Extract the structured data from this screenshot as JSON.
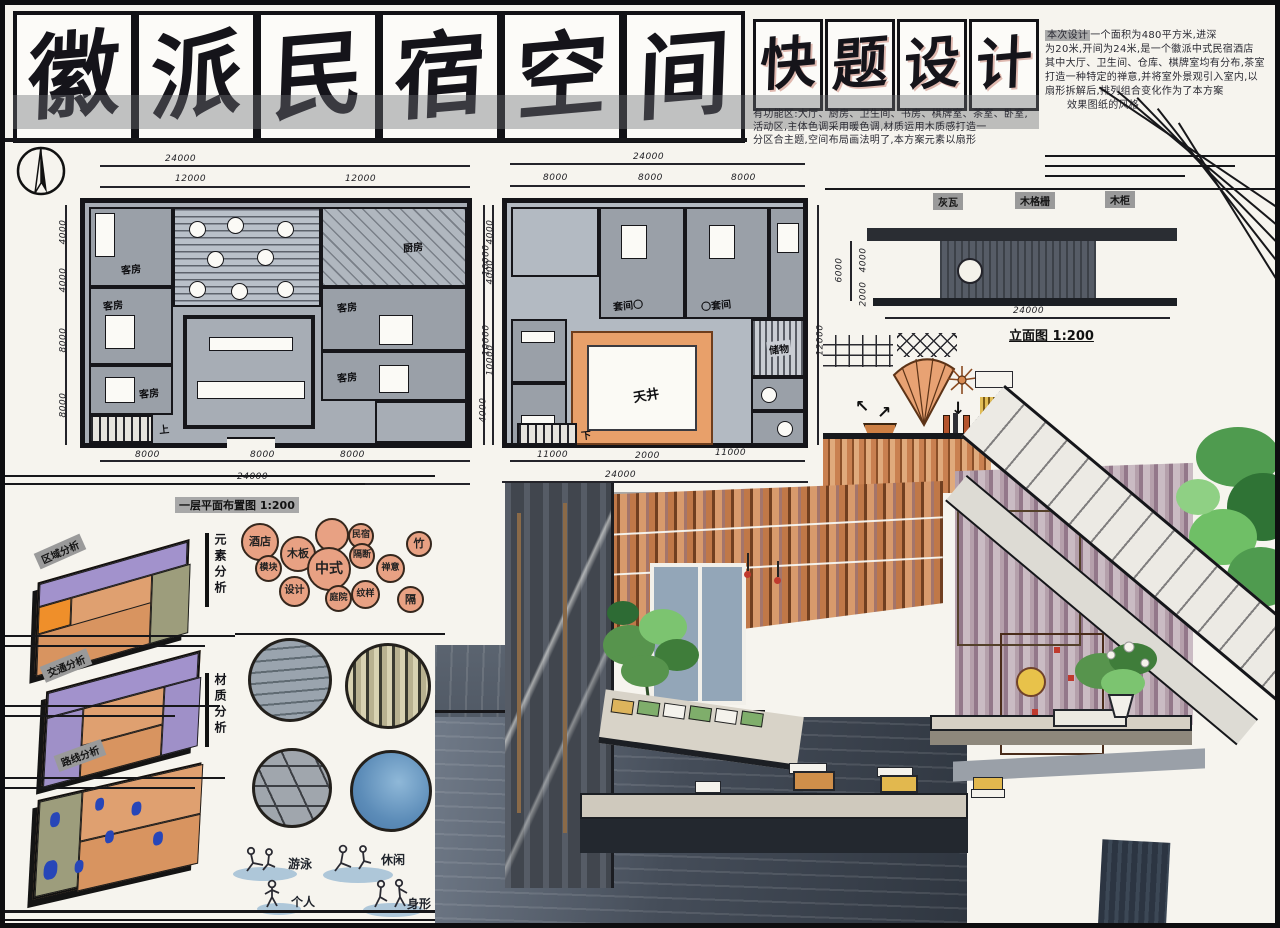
{
  "title": {
    "main": [
      "徽",
      "派",
      "民",
      "宿",
      "空",
      "间"
    ],
    "sub": [
      "快",
      "题",
      "设",
      "计"
    ]
  },
  "description": {
    "tag": "本次设计",
    "right_lines": [
      "一个面积为480平方米,进深",
      "为20米,开间为24米,是一个徽派中式民宿酒店",
      "其中大厅、卫生间、仓库、棋牌室均有分布,茶室",
      "打造一种特定的禅意,并将室外景观引入室内,以",
      "扇形拆解后,排列组合变化作为了本方案",
      "效果图纸的风格"
    ],
    "mid_lines": [
      "有功能区:大厅、厨房、卫生间、书房、棋牌室、茶室、卧室,",
      "活动区,主体色调采用暖色调,材质运用木质感打造一",
      "分区合主题,空间布局画法明了,本方案元素以扇形"
    ]
  },
  "floor1": {
    "label": "一层平面布置图 1:200",
    "rooms": {
      "guest": "客房",
      "kitchen": "厨房",
      "stair": "上"
    },
    "dims": {
      "top_total": "24000",
      "top_a": "12000",
      "top_b": "12000",
      "bottom_a": "8000",
      "bottom_b": "8000",
      "bottom_c": "8000",
      "bottom_total": "24000",
      "left": [
        "4000",
        "4000",
        "8000",
        "8000"
      ],
      "right": [
        "10000",
        "10000",
        "4000"
      ]
    }
  },
  "floor2": {
    "label": "二层平面布置图",
    "rooms": {
      "suite_a": "套间〇",
      "suite_b": "〇套间",
      "skywell": "天井",
      "storage": "储物",
      "stair": "下"
    },
    "dims": {
      "top_total": "24000",
      "top_a": "8000",
      "top_b": "8000",
      "top_c": "8000",
      "bottom_a": "11000",
      "bottom_b": "2000",
      "bottom_c": "11000",
      "bottom_total": "24000",
      "left": [
        "4000",
        "4000",
        "10000"
      ],
      "right": [
        "12000"
      ]
    }
  },
  "elevation": {
    "label": "立面图 1:200",
    "tags": [
      "灰瓦",
      "木格栅",
      "木柜"
    ],
    "dims": {
      "bottom": "24000",
      "left_total": "6000",
      "left_a": "4000",
      "left_b": "2000"
    }
  },
  "analysis": {
    "plate_tags": [
      "区域分析",
      "交通分析",
      "路线分析"
    ],
    "element_title": "元素分析",
    "material_title": "材质分析",
    "bubbles": [
      "酒店",
      "木板",
      "民宿",
      "竹",
      "模块",
      "中式",
      "隔断",
      "禅意",
      "设计",
      "庭院",
      "纹样",
      "隔"
    ],
    "figures": [
      "游泳",
      "休闲",
      "个人",
      "身形"
    ]
  }
}
